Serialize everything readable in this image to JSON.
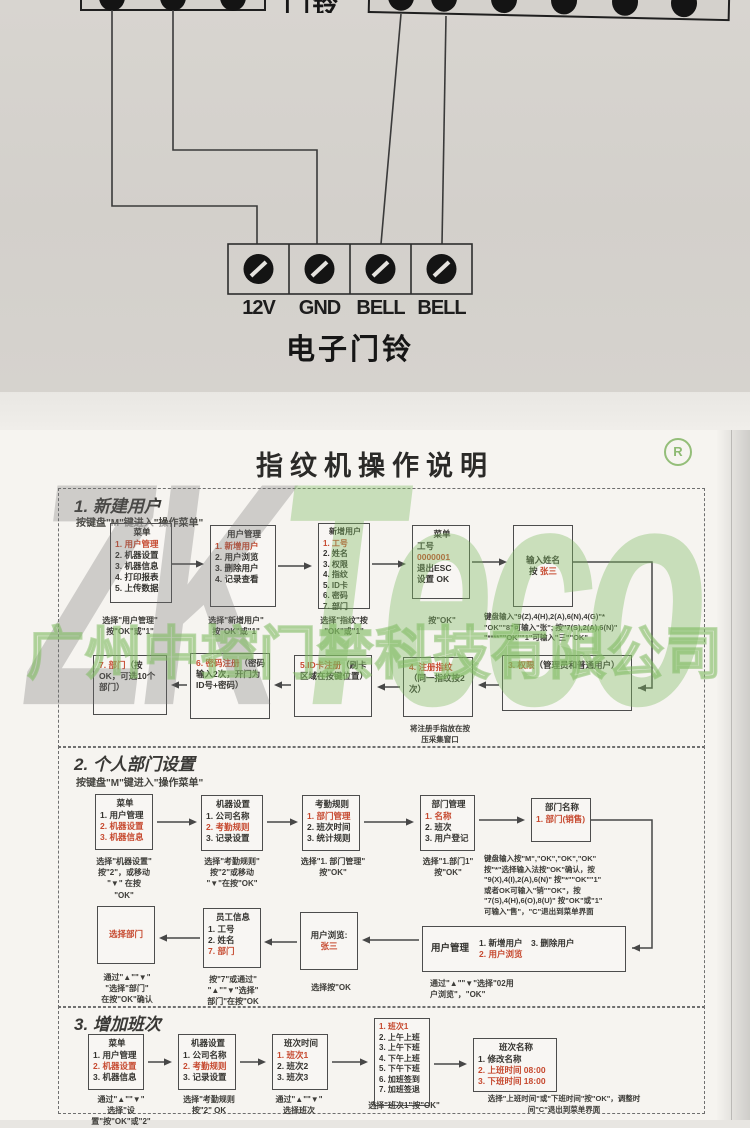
{
  "photo_top": {
    "partial_label": "门铃",
    "terminal_labels": [
      "12V",
      "GND",
      "BELL",
      "BELL"
    ],
    "caption": "电子门铃"
  },
  "manual": {
    "title": "指纹机操作说明",
    "reg_mark": "R",
    "watermark": {
      "zk": "ZK",
      "teco": "Teco",
      "company": "广州中控门禁科技有限公司"
    },
    "colors": {
      "highlight_red": "#c6492f",
      "watermark_green": "#7eba60",
      "paper": "#f6f4f0"
    },
    "sections": [
      {
        "header": "1. 新建用户",
        "subtitle": "按键盘\"M\"键进入\"操作菜单\"",
        "boxes": [
          {
            "id": "s1b1",
            "title": "菜单",
            "lines": [
              {
                "t": "1. 用户管理",
                "red": true
              },
              "2. 机器设置",
              "3. 机器信息",
              "4. 打印报表",
              "5. 上传数据"
            ]
          },
          {
            "id": "s1b2",
            "title": "用户管理",
            "lines": [
              {
                "t": "1. 新增用户",
                "red": true
              },
              "2. 用户浏览",
              "3. 删除用户",
              "4. 记录查看"
            ]
          },
          {
            "id": "s1b3",
            "title": "新增用户",
            "lines": [
              {
                "t": "1. 工号",
                "red": true
              },
              "2. 姓名",
              "3. 权限",
              "4. 指纹",
              "5. ID卡",
              "6. 密码",
              "7. 部门"
            ]
          },
          {
            "id": "s1b4",
            "title": "菜单",
            "lines": [
              "工号",
              {
                "t": "0000001",
                "red": true
              },
              "退出ESC",
              "设置 OK"
            ]
          },
          {
            "id": "s1b5",
            "lines": [
              "输入姓名",
              [
                {
                  "t": "按 "
                },
                {
                  "t": "张三",
                  "red": true
                }
              ]
            ]
          },
          {
            "id": "s1b6",
            "text": [
              {
                "t": "3. 权限",
                "red": true
              },
              {
                "t": "（管理员和普通用户）"
              }
            ]
          },
          {
            "id": "s1b7",
            "text": [
              {
                "t": "4. 注册指纹",
                "red": true
              },
              {
                "t": "（同一指纹按2次）"
              }
            ]
          },
          {
            "id": "s1b8",
            "text": [
              {
                "t": "5.ID卡注册",
                "red": true
              },
              {
                "t": "（刷卡区域在按键位置）"
              }
            ]
          },
          {
            "id": "s1b9",
            "text": [
              {
                "t": "6. 密码注册",
                "red": true
              },
              {
                "t": "（密码输入2次，开门为ID号+密码）"
              }
            ]
          },
          {
            "id": "s1b10",
            "text": [
              {
                "t": "7. 部门",
                "red": true
              },
              {
                "t": "（按OK，可选10个部门）"
              }
            ]
          }
        ],
        "captions": [
          {
            "id": "s1c1",
            "lines": [
              "选择\"用户管理\"",
              "按\"OK\"或\"1\""
            ]
          },
          {
            "id": "s1c2",
            "lines": [
              "选择\"新增用户\"",
              "按\"OK\"或\"1\""
            ]
          },
          {
            "id": "s1c3",
            "lines": [
              "选择\"指纹\"按",
              "\"OK\"或\"1\""
            ]
          },
          {
            "id": "s1c4",
            "lines": [
              "按\"OK\""
            ]
          },
          {
            "id": "s1c5",
            "lines": [
              "键盘输入\"9(Z),4(H),2(A),6(N),4(G)\"*",
              "\"OK\"\"8\"可输入\"张\"; 按\"7(S),2(A),6(N)\"",
              "\"****\"\"OK\"\"1\"可输入\"三\"\"OK\""
            ]
          },
          {
            "id": "s1c6",
            "lines": [
              "将注册手指放在按",
              "压采集窗口"
            ]
          }
        ]
      },
      {
        "header": "2. 个人部门设置",
        "subtitle": "按键盘\"M\"键进入\"操作菜单\"",
        "boxes": [
          {
            "id": "s2b1",
            "title": "菜单",
            "lines": [
              "1. 用户管理",
              {
                "t": "2. 机器设置",
                "red": true
              },
              {
                "t": "3. 机器信息",
                "red": true
              }
            ]
          },
          {
            "id": "s2b2",
            "title": "机器设置",
            "lines": [
              "1. 公司名称",
              {
                "t": "2. 考勤规则",
                "red": true
              },
              "3. 记录设置"
            ]
          },
          {
            "id": "s2b3",
            "title": "考勤规则",
            "lines": [
              {
                "t": "1. 部门管理",
                "red": true
              },
              "2. 班次时间",
              "3. 统计规则"
            ]
          },
          {
            "id": "s2b4",
            "title": "部门管理",
            "lines": [
              {
                "t": "1. 名称",
                "red": true
              },
              "2. 班次",
              "3. 用户登记"
            ]
          },
          {
            "id": "s2b5",
            "title": "部门名称",
            "lines": [
              {
                "t": "1. 部门(销售)",
                "red": true
              }
            ]
          },
          {
            "id": "s2b6",
            "label": "用户管理",
            "lines": [
              "1. 新增用户　3. 删除用户",
              {
                "t": "2. 用户浏览",
                "red": true
              }
            ]
          },
          {
            "id": "s2b7",
            "lines": [
              "用户浏览:",
              [
                {
                  "t": "张三",
                  "red": true
                }
              ]
            ]
          },
          {
            "id": "s2b8",
            "title": "员工信息",
            "lines": [
              "1. 工号",
              "2. 姓名",
              {
                "t": "7. 部门",
                "red": true
              }
            ]
          },
          {
            "id": "s2b9",
            "lines": [
              [
                {
                  "t": "选择部门",
                  "red": true
                }
              ]
            ]
          }
        ],
        "captions": [
          {
            "id": "s2c1",
            "lines": [
              "选择\"机器设置\"",
              "按\"2\"，或移动",
              "\"▼\" 在按",
              "\"OK\""
            ]
          },
          {
            "id": "s2c2",
            "lines": [
              "选择\"考勤规则\"",
              "按\"2\"或移动",
              "\"▼\"在按\"OK\""
            ]
          },
          {
            "id": "s2c3",
            "lines": [
              "选择\"1. 部门管理\"",
              "按\"OK\""
            ]
          },
          {
            "id": "s2c4",
            "lines": [
              "选择\"1.部门1\"",
              "按\"OK\""
            ]
          },
          {
            "id": "s2c5",
            "lines": [
              "键盘输入按\"M\",\"OK\",\"OK\",\"OK\"",
              "按\"*\"选择输入法按\"OK\"确认，按",
              "\"9(X),4(I),2(A),6(N)\" 按\"*\"\"OK\"\"1\"",
              "或者OK可输入\"销\"\"OK\"，按",
              "\"7(S),4(H),6(O),8(U)\" 按\"OK\"或\"1\"",
              "可输入\"售\"，\"C\"退出到菜单界面"
            ]
          },
          {
            "id": "s2c6",
            "lines": [
              "通过\"▲\"\"▼\"选择\"02用",
              "户浏览\"，\"OK\""
            ]
          },
          {
            "id": "s2c7",
            "lines": [
              "选择按\"OK"
            ]
          },
          {
            "id": "s2c8",
            "lines": [
              "按\"7\"或通过\"",
              "\"▲\"\"▼\"选择\"",
              "部门\"在按\"OK"
            ]
          },
          {
            "id": "s2c9",
            "lines": [
              "通过\"▲\"\"▼\"",
              "\"选择\"部门\"",
              "在按\"OK\"确认"
            ]
          }
        ]
      },
      {
        "header": "3. 增加班次",
        "boxes": [
          {
            "id": "s3b1",
            "title": "菜单",
            "lines": [
              "1. 用户管理",
              {
                "t": "2. 机器设置",
                "red": true
              },
              "3. 机器信息"
            ]
          },
          {
            "id": "s3b2",
            "title": "机器设置",
            "lines": [
              "1. 公司名称",
              {
                "t": "2. 考勤规则",
                "red": true
              },
              "3. 记录设置"
            ]
          },
          {
            "id": "s3b3",
            "title": "班次时间",
            "lines": [
              {
                "t": "1. 班次1",
                "red": true
              },
              "2. 班次2",
              "3. 班次3"
            ]
          },
          {
            "id": "s3b4",
            "lines": [
              {
                "t": "1. 班次1",
                "red": true
              },
              "2. 上午上班",
              "3. 上午下班",
              "4. 下午上班",
              "5. 下午下班",
              "6. 加班签到",
              "7. 加班签退"
            ]
          },
          {
            "id": "s3b5",
            "title": "班次名称",
            "lines": [
              "1. 修改名称",
              {
                "t": "2. 上班时间 08:00",
                "red": true
              },
              {
                "t": "3. 下班时间 18:00",
                "red": true
              }
            ]
          }
        ],
        "captions": [
          {
            "id": "s3c1",
            "lines": [
              "通过\"▲\"\"▼\"",
              "选择\"设置\"按\"OK\"或\"2\""
            ]
          },
          {
            "id": "s3c2",
            "lines": [
              "选择\"考勤规则",
              "按\"2\" OK"
            ]
          },
          {
            "id": "s3c3",
            "lines": [
              "通过\"▲\"\"▼\"",
              "选择班次"
            ]
          },
          {
            "id": "s3c4",
            "lines": [
              "选择\"班次1\"按\"OK\""
            ]
          },
          {
            "id": "s3c5",
            "lines": [
              "选择\"上班时间\"或\"下班时间\"按\"OK\"，调整时",
              "间\"C\"退出到菜单界面"
            ]
          }
        ]
      }
    ]
  }
}
